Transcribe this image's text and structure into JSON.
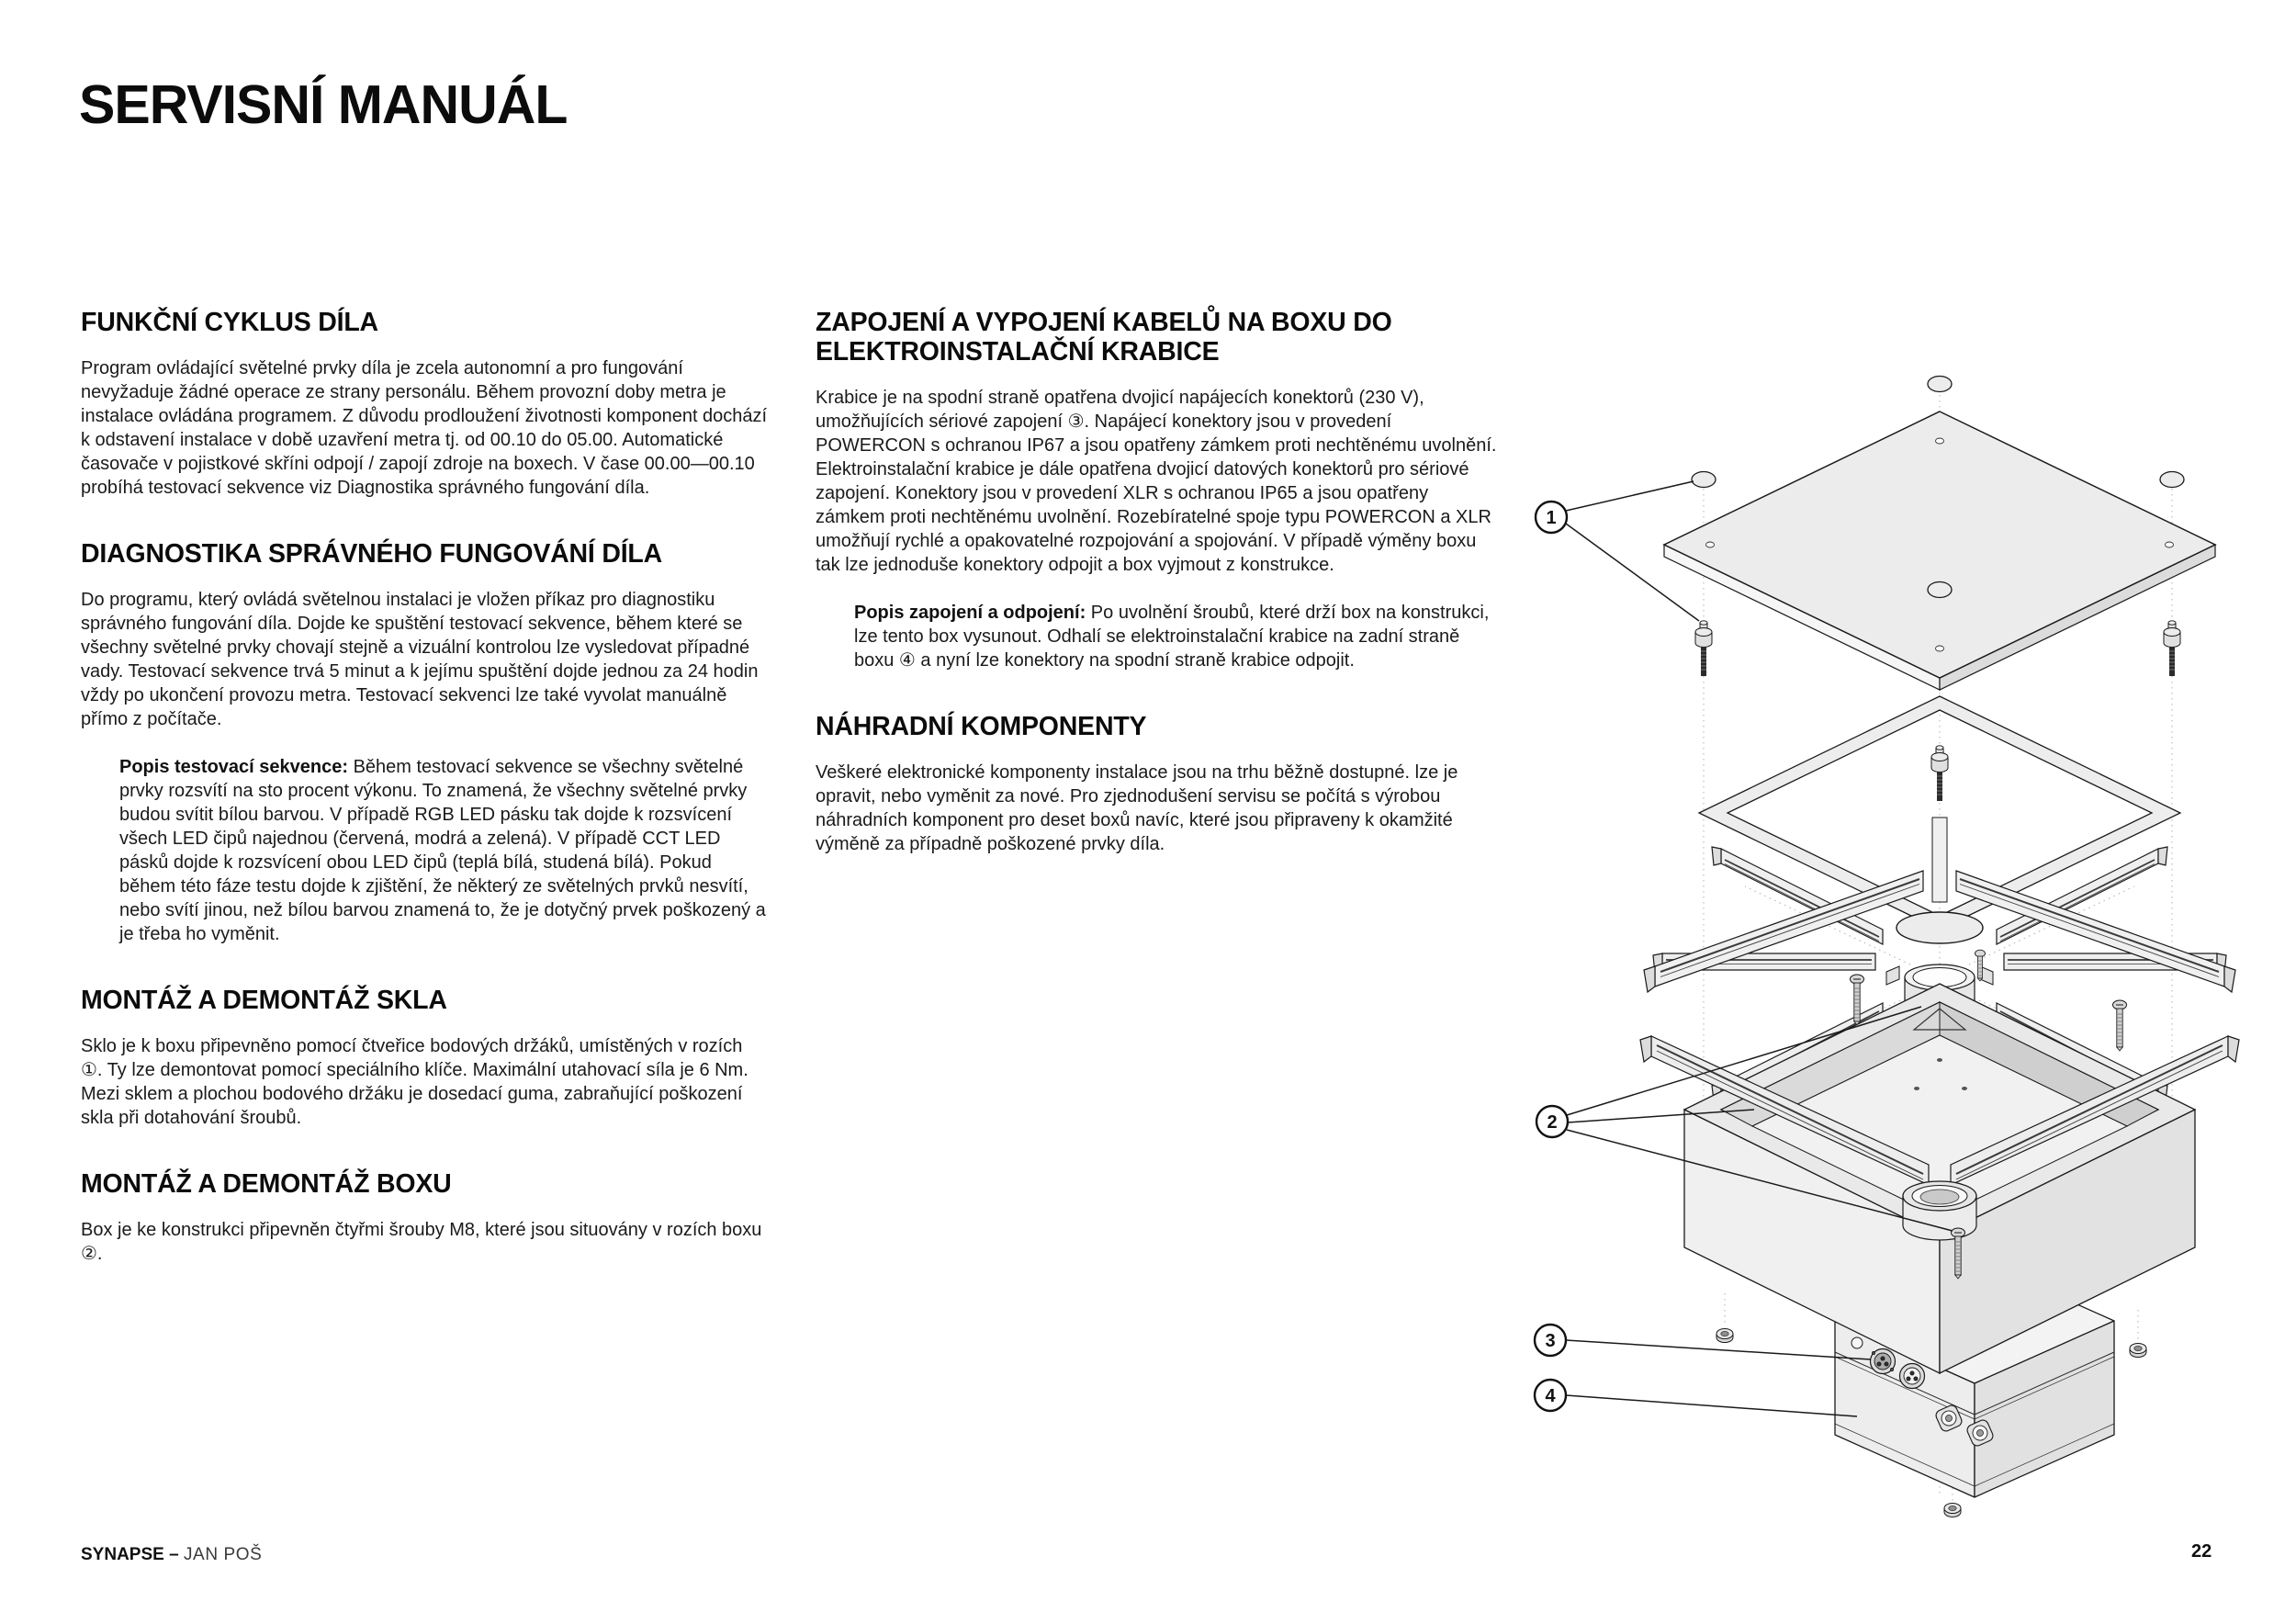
{
  "page": {
    "title": "SERVISNÍ MANUÁL",
    "page_number": "22",
    "footer": {
      "brand": "SYNAPSE",
      "dash": "–",
      "author": "JAN POŠ"
    }
  },
  "columns": {
    "left": [
      {
        "heading": "FUNKČNÍ CYKLUS DÍLA",
        "paragraphs": [
          {
            "text": "Program ovládající světelné prvky díla je zcela autonomní a pro fungování nevyžaduje žádné operace ze strany personálu. Během provozní doby metra je instalace ovládána programem. Z důvodu prodloužení životnosti komponent dochází k odstavení instalace v době uzavření metra tj. od 00.10 do 05.00. Automatické časovače v pojistkové skříni odpojí / zapojí zdroje na boxech. V čase 00.00—00.10 probíhá testovací sekvence viz Diagnostika správného fungování díla."
          }
        ]
      },
      {
        "heading": "DIAGNOSTIKA SPRÁVNÉHO FUNGOVÁNÍ DÍLA",
        "paragraphs": [
          {
            "text": "Do programu, který ovládá světelnou instalaci je vložen příkaz pro diagnostiku správného fungování díla. Dojde ke spuštění testovací sekvence, během které se všechny světelné prvky chovají stejně a vizuální kontrolou lze vysledovat případné vady. Testovací sekvence trvá 5 minut a k jejímu spuštění dojde jednou za 24 hodin vždy po ukončení provozu metra. Testovací sekvenci lze také vyvolat manuálně přímo z počítače."
          },
          {
            "lead": "Popis testovací sekvence:",
            "text": " Během testovací sekvence se všechny světelné prvky rozsvítí na sto procent výkonu. To znamená, že všechny světelné prvky budou svítit bílou barvou. V případě RGB LED pásku tak dojde k rozsvícení všech LED čipů najednou (červená, modrá a zelená). V případě CCT LED pásků dojde k rozsvícení obou LED čipů (teplá bílá, studená bílá). Pokud během této fáze testu dojde k zjištění, že některý ze světelných prvků nesvítí, nebo svítí jinou, než bílou barvou znamená to, že je dotyčný prvek poškozený a je třeba ho vyměnit."
          }
        ]
      },
      {
        "heading": "MONTÁŽ A DEMONTÁŽ SKLA",
        "paragraphs": [
          {
            "text": "Sklo je k boxu připevněno pomocí čtveřice bodových držáků, umístěných v rozích ①. Ty lze demontovat pomocí speciálního klíče. Maximální utahovací síla je 6 Nm. Mezi sklem a plochou bodového držáku je dosedací guma, zabraňující poškození skla při dotahování šroubů."
          }
        ]
      },
      {
        "heading": "MONTÁŽ A DEMONTÁŽ BOXU",
        "paragraphs": [
          {
            "text": "Box je ke konstrukci připevněn čtyřmi šrouby M8, které jsou situovány v rozích boxu ②."
          }
        ]
      }
    ],
    "middle": [
      {
        "heading": "ZAPOJENÍ A VYPOJENÍ KABELŮ NA BOXU DO ELEKTROINSTALAČNÍ KRABICE",
        "paragraphs": [
          {
            "text": "Krabice je na spodní straně opatřena dvojicí napájecích konektorů (230 V), umožňujících sériové zapojení ③. Napájecí konektory jsou v provedení POWERCON s ochranou IP67 a jsou opatřeny zámkem proti nechtěnému uvolnění. Elektroinstalační krabice je dále opatřena dvojicí datových konektorů pro sériové zapojení. Konektory jsou v provedení XLR s ochranou IP65 a jsou opatřeny zámkem proti nechtěnému uvolnění. Rozebíratelné spoje typu POWERCON a XLR umožňují rychlé a opakovatelné rozpojování a spojování. V případě výměny boxu tak lze jednoduše konektory odpojit a box vyjmout z konstrukce."
          },
          {
            "lead": "Popis zapojení a odpojení:",
            "text": " Po uvolnění šroubů, které drží box na konstrukci, lze tento box vysunout. Odhalí se elektroinstalační krabice na zadní straně boxu ④ a nyní lze konektory na spodní straně krabice odpojit."
          }
        ]
      },
      {
        "heading": "NÁHRADNÍ KOMPONENTY",
        "paragraphs": [
          {
            "text": "Veškeré elektronické komponenty instalace jsou na trhu běžně dostupné. lze je opravit, nebo vyměnit za nové. Pro zjednodušení servisu se počítá s výrobou náhradních komponent pro deset boxů navíc, které jsou připraveny k okamžité výměně za případně poškozené prvky díla."
          }
        ]
      }
    ]
  },
  "diagram": {
    "description": "Exploded isometric view of light box assembly",
    "callout_labels": [
      "1",
      "2",
      "3",
      "4"
    ]
  }
}
